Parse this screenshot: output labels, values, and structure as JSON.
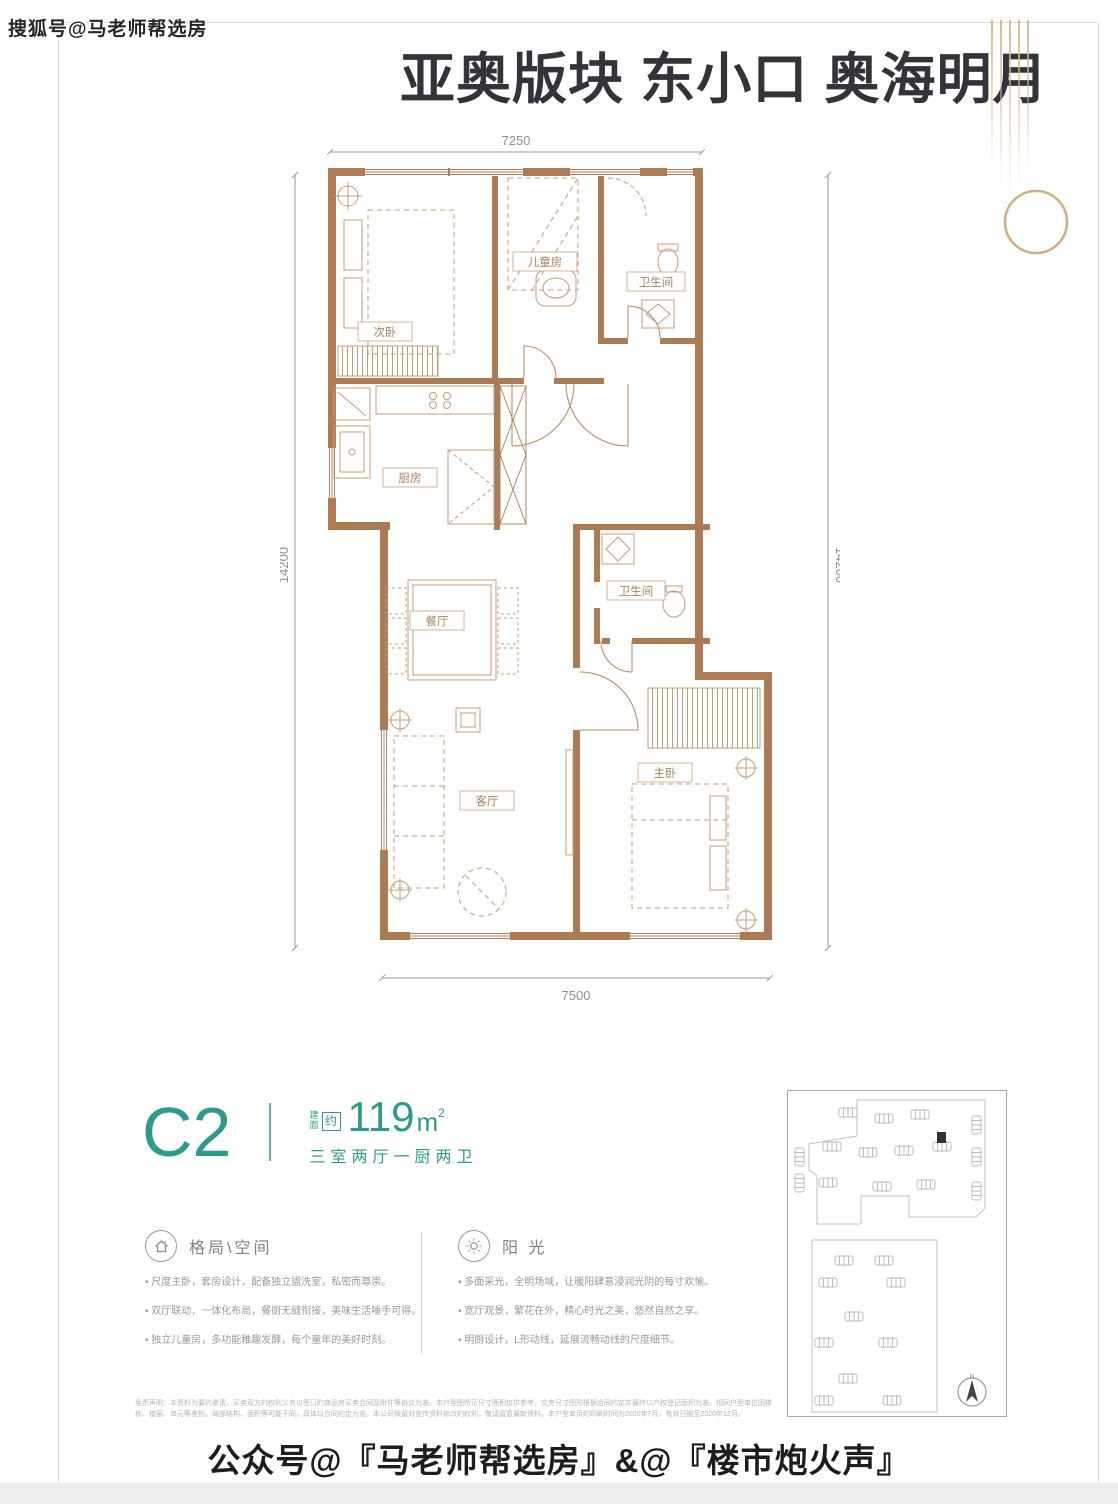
{
  "page": {
    "watermark": "搜狐号@马老师帮选房",
    "title": "亚奥版块 东小口 奥海明月",
    "footer": "公众号@『马老师帮选房』&@『楼市炮火声』"
  },
  "plan": {
    "dims": {
      "top": "7250",
      "left": "14200",
      "right": "14200",
      "bottom": "7500"
    },
    "rooms": [
      {
        "label": "次卧"
      },
      {
        "label": "儿童房"
      },
      {
        "label": "卫生间"
      },
      {
        "label": "厨房"
      },
      {
        "label": "餐厅"
      },
      {
        "label": "卫生间"
      },
      {
        "label": "客厅"
      },
      {
        "label": "主卧"
      }
    ]
  },
  "unit": {
    "code": "C2",
    "jian": "建",
    "mian": "面",
    "approx": "约",
    "area": "119",
    "unit_m": "m",
    "sup": "2",
    "desc": "三室两厅一厨两卫"
  },
  "sections": [
    {
      "title": "格局\\空间",
      "icon": "house-icon",
      "bullets": [
        "尺度主卧，套房设计，配备独立盥洗室，私密而尊崇。",
        "双厅联动，一体化布局，餐厨无缝衔接，美味生活唾手可得。",
        "独立儿童房，多功能稚趣发酵，每个童年的美好时刻。"
      ]
    },
    {
      "title": "阳 光",
      "icon": "sun-icon",
      "bullets": [
        "多面采光，全明场域，让暖阳肆意浸润光阴的每寸欢愉。",
        "宽厅观景，繁花在外，精心时光之美，悠然自然之享。",
        "明厨设计，L形动线，延展流畅动线的尺度细节。"
      ]
    }
  ],
  "disclaimer": {
    "text": "免责声明：本资料为要约邀请，买卖双方的权利义务以签订的商品房买卖合同及附件等协议为准。本户型图所示尺寸面积仅供参考，交房尺寸图形根据合同约定并最终以产权登记面积为准。相同户型单位因楼栋、楼层、单元等差别，局部结构、面积等可能不同，具体以合同约定为准。本公司保留对宣传资料修改的权利，敬请留意最新资料。本户型单页的印刷时间为2020年7月，有效日期至2020年12月。"
  },
  "site_plan": {
    "north_label": "N"
  },
  "colors": {
    "accent_teal": "#2f9a8b",
    "wall_brown": "#ad7c55",
    "gold": "#c9a26b",
    "title_dark": "#33343a"
  }
}
